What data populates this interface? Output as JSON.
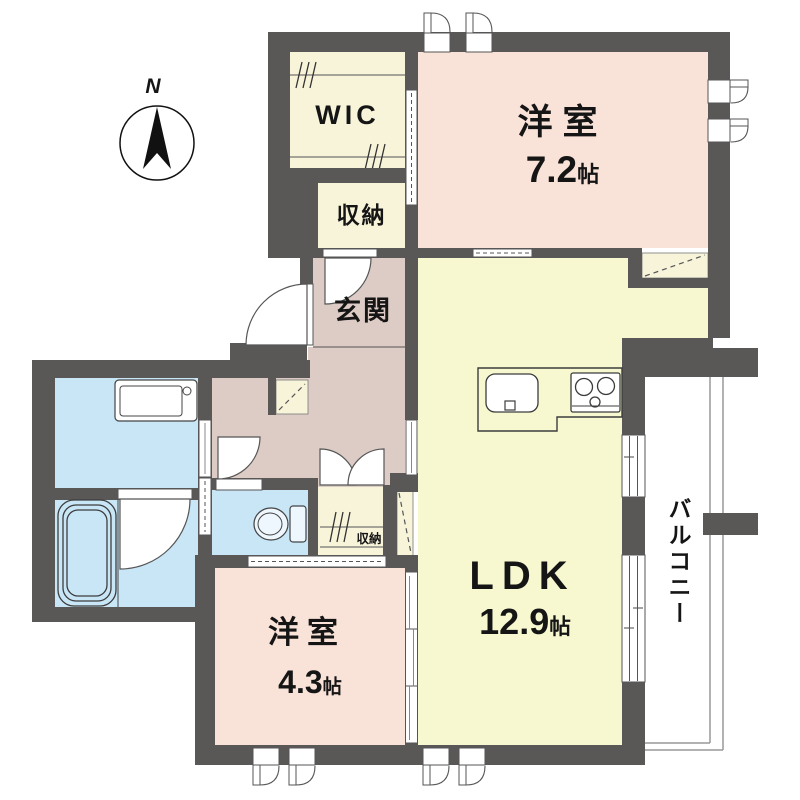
{
  "compass": {
    "north_label": "N"
  },
  "rooms": {
    "bedroom_7_2": {
      "name": "洋室",
      "size": "7.2",
      "unit": "帖"
    },
    "ldk": {
      "name": "LDK",
      "size": "12.9",
      "unit": "帖"
    },
    "bedroom_4_3": {
      "name": "洋室",
      "size": "4.3",
      "unit": "帖"
    },
    "wic": {
      "label": "WIC"
    },
    "hall_closet": {
      "label": "収納"
    },
    "bedroom_closet": {
      "label": "収納"
    },
    "entrance": {
      "label": "玄関"
    },
    "balcony": {
      "label": "バルコニー"
    }
  },
  "colors": {
    "wall": "#5a5757",
    "bedroom_floor": "#f9e2d8",
    "ldk_floor": "#f7f8d0",
    "storage_floor": "#f8f4da",
    "entrance_floor": "#ddccc5",
    "wet_area_floor": "#c9e6f7",
    "balcony_line": "#999999",
    "text": "#151515"
  }
}
